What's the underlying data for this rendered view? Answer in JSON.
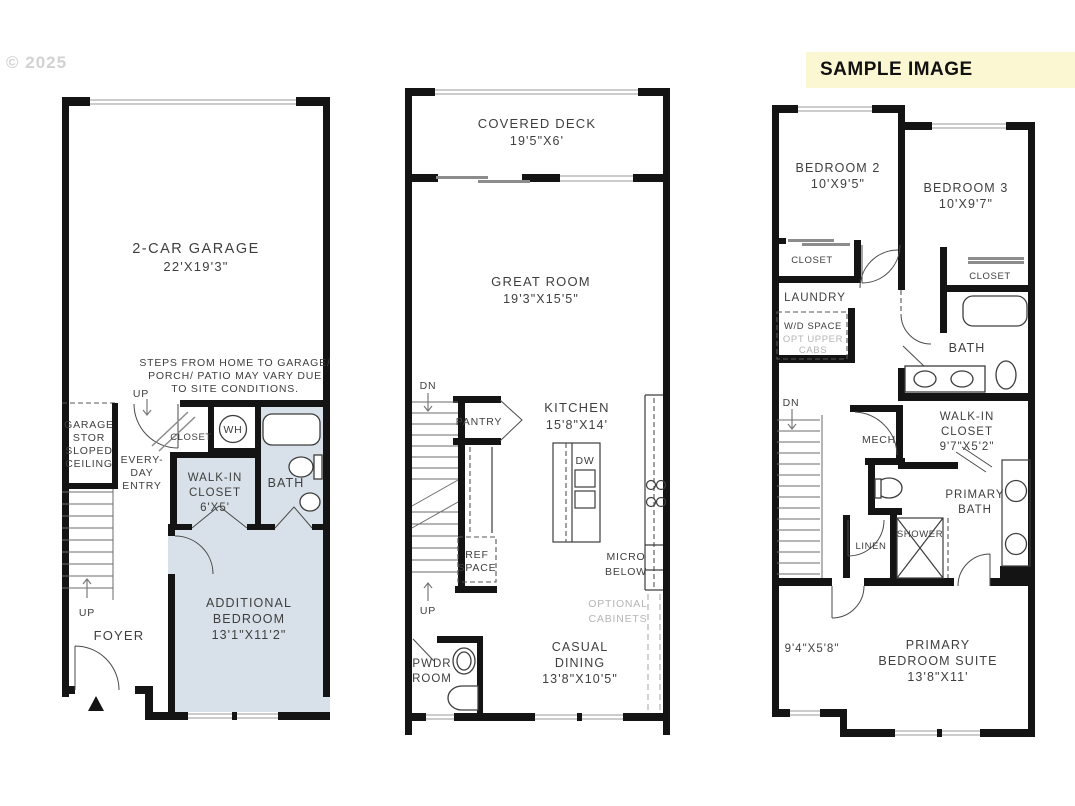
{
  "watermark": "© 2025",
  "banner": {
    "label": "SAMPLE IMAGE"
  },
  "colors": {
    "wall": "#141414",
    "highlight_room_fill": "#d8e1e9",
    "text": "#3f3f3f",
    "muted_text": "#b5b5b5",
    "banner_bg": "#fbf7d2",
    "watermark": "#d2d2d2"
  },
  "floor1": {
    "garage": {
      "name": "2-CAR GARAGE",
      "dims": "22'X19'3\""
    },
    "site_note": [
      "STEPS FROM HOME TO GARAGE/",
      "PORCH/ PATIO MAY VARY DUE",
      "TO SITE CONDITIONS."
    ],
    "up_to_entry": "UP",
    "garage_stor": [
      "GARAGE",
      "STOR",
      "SLOPED",
      "CEILING"
    ],
    "closet": "CLOSET",
    "water_heater": "WH",
    "everyday_entry": [
      "EVERY-",
      "DAY",
      "ENTRY"
    ],
    "walk_in_closet": [
      "WALK-IN",
      "CLOSET",
      "6'X5'"
    ],
    "bath": "BATH",
    "stairs_up": "UP",
    "foyer": "FOYER",
    "additional_bedroom": [
      "ADDITIONAL",
      "BEDROOM",
      "13'1\"X11'2\""
    ]
  },
  "floor2": {
    "covered_deck": {
      "name": "COVERED DECK",
      "dims": "19'5\"X6'"
    },
    "great_room": {
      "name": "GREAT ROOM",
      "dims": "19'3\"X15'5\""
    },
    "stairs_down": "DN",
    "pantry": "PANTRY",
    "kitchen": {
      "name": "KITCHEN",
      "dims": "15'8\"X14'"
    },
    "dishwasher": "DW",
    "ref_space": [
      "REF",
      "SPACE"
    ],
    "micro_below": [
      "MICRO",
      "BELOW"
    ],
    "optional_cabinets": [
      "OPTIONAL",
      "CABINETS"
    ],
    "stairs_up": "UP",
    "powder_room": [
      "PWDR",
      "ROOM"
    ],
    "casual_dining": [
      "CASUAL",
      "DINING",
      "13'8\"X10'5\""
    ]
  },
  "floor3": {
    "bedroom2": {
      "name": "BEDROOM 2",
      "dims": "10'X9'5\""
    },
    "bedroom3": {
      "name": "BEDROOM 3",
      "dims": "10'X9'7\""
    },
    "closet2": "CLOSET",
    "closet3": "CLOSET",
    "laundry": "LAUNDRY",
    "wd_space": "W/D SPACE",
    "opt_upper_cabs": [
      "OPT UPPER",
      "CABS"
    ],
    "bath": "BATH",
    "stairs_down": "DN",
    "mech": "MECH",
    "walk_in_closet": [
      "WALK-IN",
      "CLOSET",
      "9'7\"X5'2\""
    ],
    "primary_bath": [
      "PRIMARY",
      "BATH"
    ],
    "linen": "LINEN",
    "shower": "SHOWER",
    "hall_dims": "9'4\"X5'8\"",
    "primary_suite": [
      "PRIMARY",
      "BEDROOM SUITE",
      "13'8\"X11'"
    ]
  }
}
